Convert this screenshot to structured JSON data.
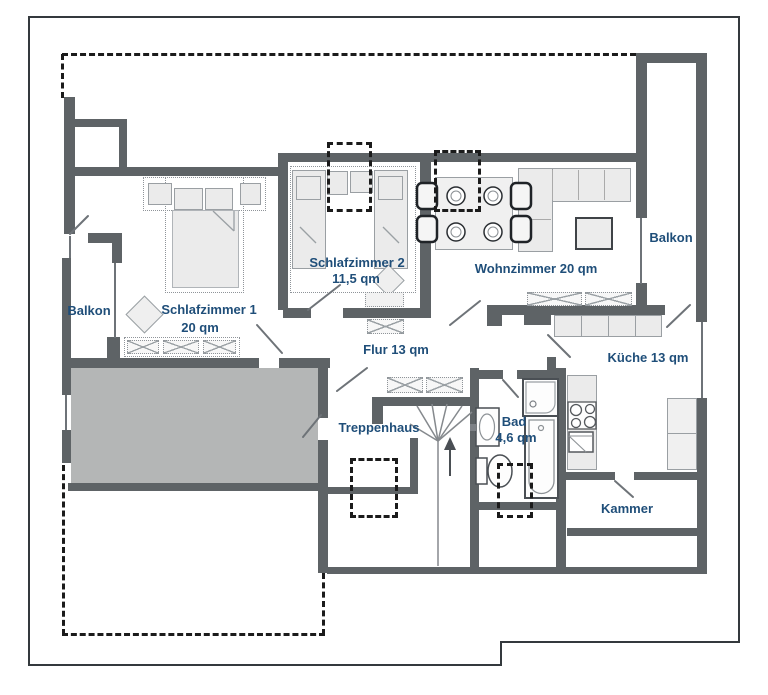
{
  "title": "Wohnungsgrundriss",
  "palette": {
    "wall": "#5e6366",
    "thin_line": "#6e7378",
    "label_blue": "#1f4e79",
    "dashed_black": "#1b1b1b",
    "furniture_fill": "#ebebeb",
    "furniture_border": "#9a9fa3",
    "gray_room_fill": "#b4b6b6",
    "page_border": "#34393d"
  },
  "rooms": {
    "balkon_left": {
      "label": "Balkon"
    },
    "schlafzimmer1": {
      "label": "Schlafzimmer 1",
      "area": "20 qm"
    },
    "schlafzimmer2": {
      "label": "Schlafzimmer 2",
      "area": "11,5 qm"
    },
    "wohnzimmer": {
      "label": "Wohnzimmer 20 qm"
    },
    "balkon_right": {
      "label": "Balkon"
    },
    "flur": {
      "label": "Flur  13 qm"
    },
    "kueche": {
      "label": "Küche 13 qm"
    },
    "treppenhaus": {
      "label": "Treppenhaus"
    },
    "bad": {
      "label": "Bad",
      "area": "4,6 qm"
    },
    "kammer": {
      "label": "Kammer"
    }
  }
}
